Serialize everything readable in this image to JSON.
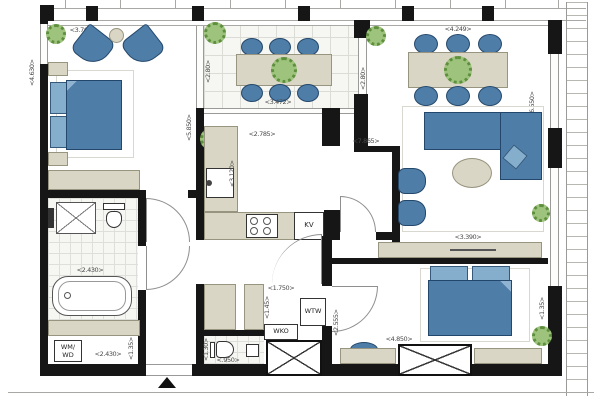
{
  "title": "apartment-floor-plan",
  "labels": {
    "bedroom1_width": "<3.768>",
    "bedroom1_height": "<4.630>",
    "balcony_width": "<3.472>",
    "balcony_depth_left": "<2.80>",
    "balcony_depth_right": "<2.80>",
    "living_width": "<4.249>",
    "living_height": "<6.550>",
    "living_sideboard": "<3.390>",
    "kitchen_width": "<2.785>",
    "apartment_length": "<7.865>",
    "kitchen_height": "<3.120>",
    "kitchen_left_height": "<5.850>",
    "fridge": "KV",
    "bath_width": "<2.430>",
    "utility_width": "<2.430>",
    "utility_height": "<1.35>",
    "utility_unit_line1": "WM/",
    "utility_unit_line2": "WD",
    "hall_width": "<1.750>",
    "hall_height": "<1.45>",
    "wtw": "WTW",
    "wko": "WKO",
    "toilet_height": "<1.30>",
    "toilet_width": "<.950>",
    "bedroom2_width": "<4.850>",
    "bedroom2_height": "<2.555>",
    "bedroom2_right": "<1.35>"
  },
  "colors": {
    "wall": "#161616",
    "furniture_blue": "#4e7da8",
    "furniture_beige": "#d9d6c5",
    "plant_green": "#9dc37c"
  }
}
